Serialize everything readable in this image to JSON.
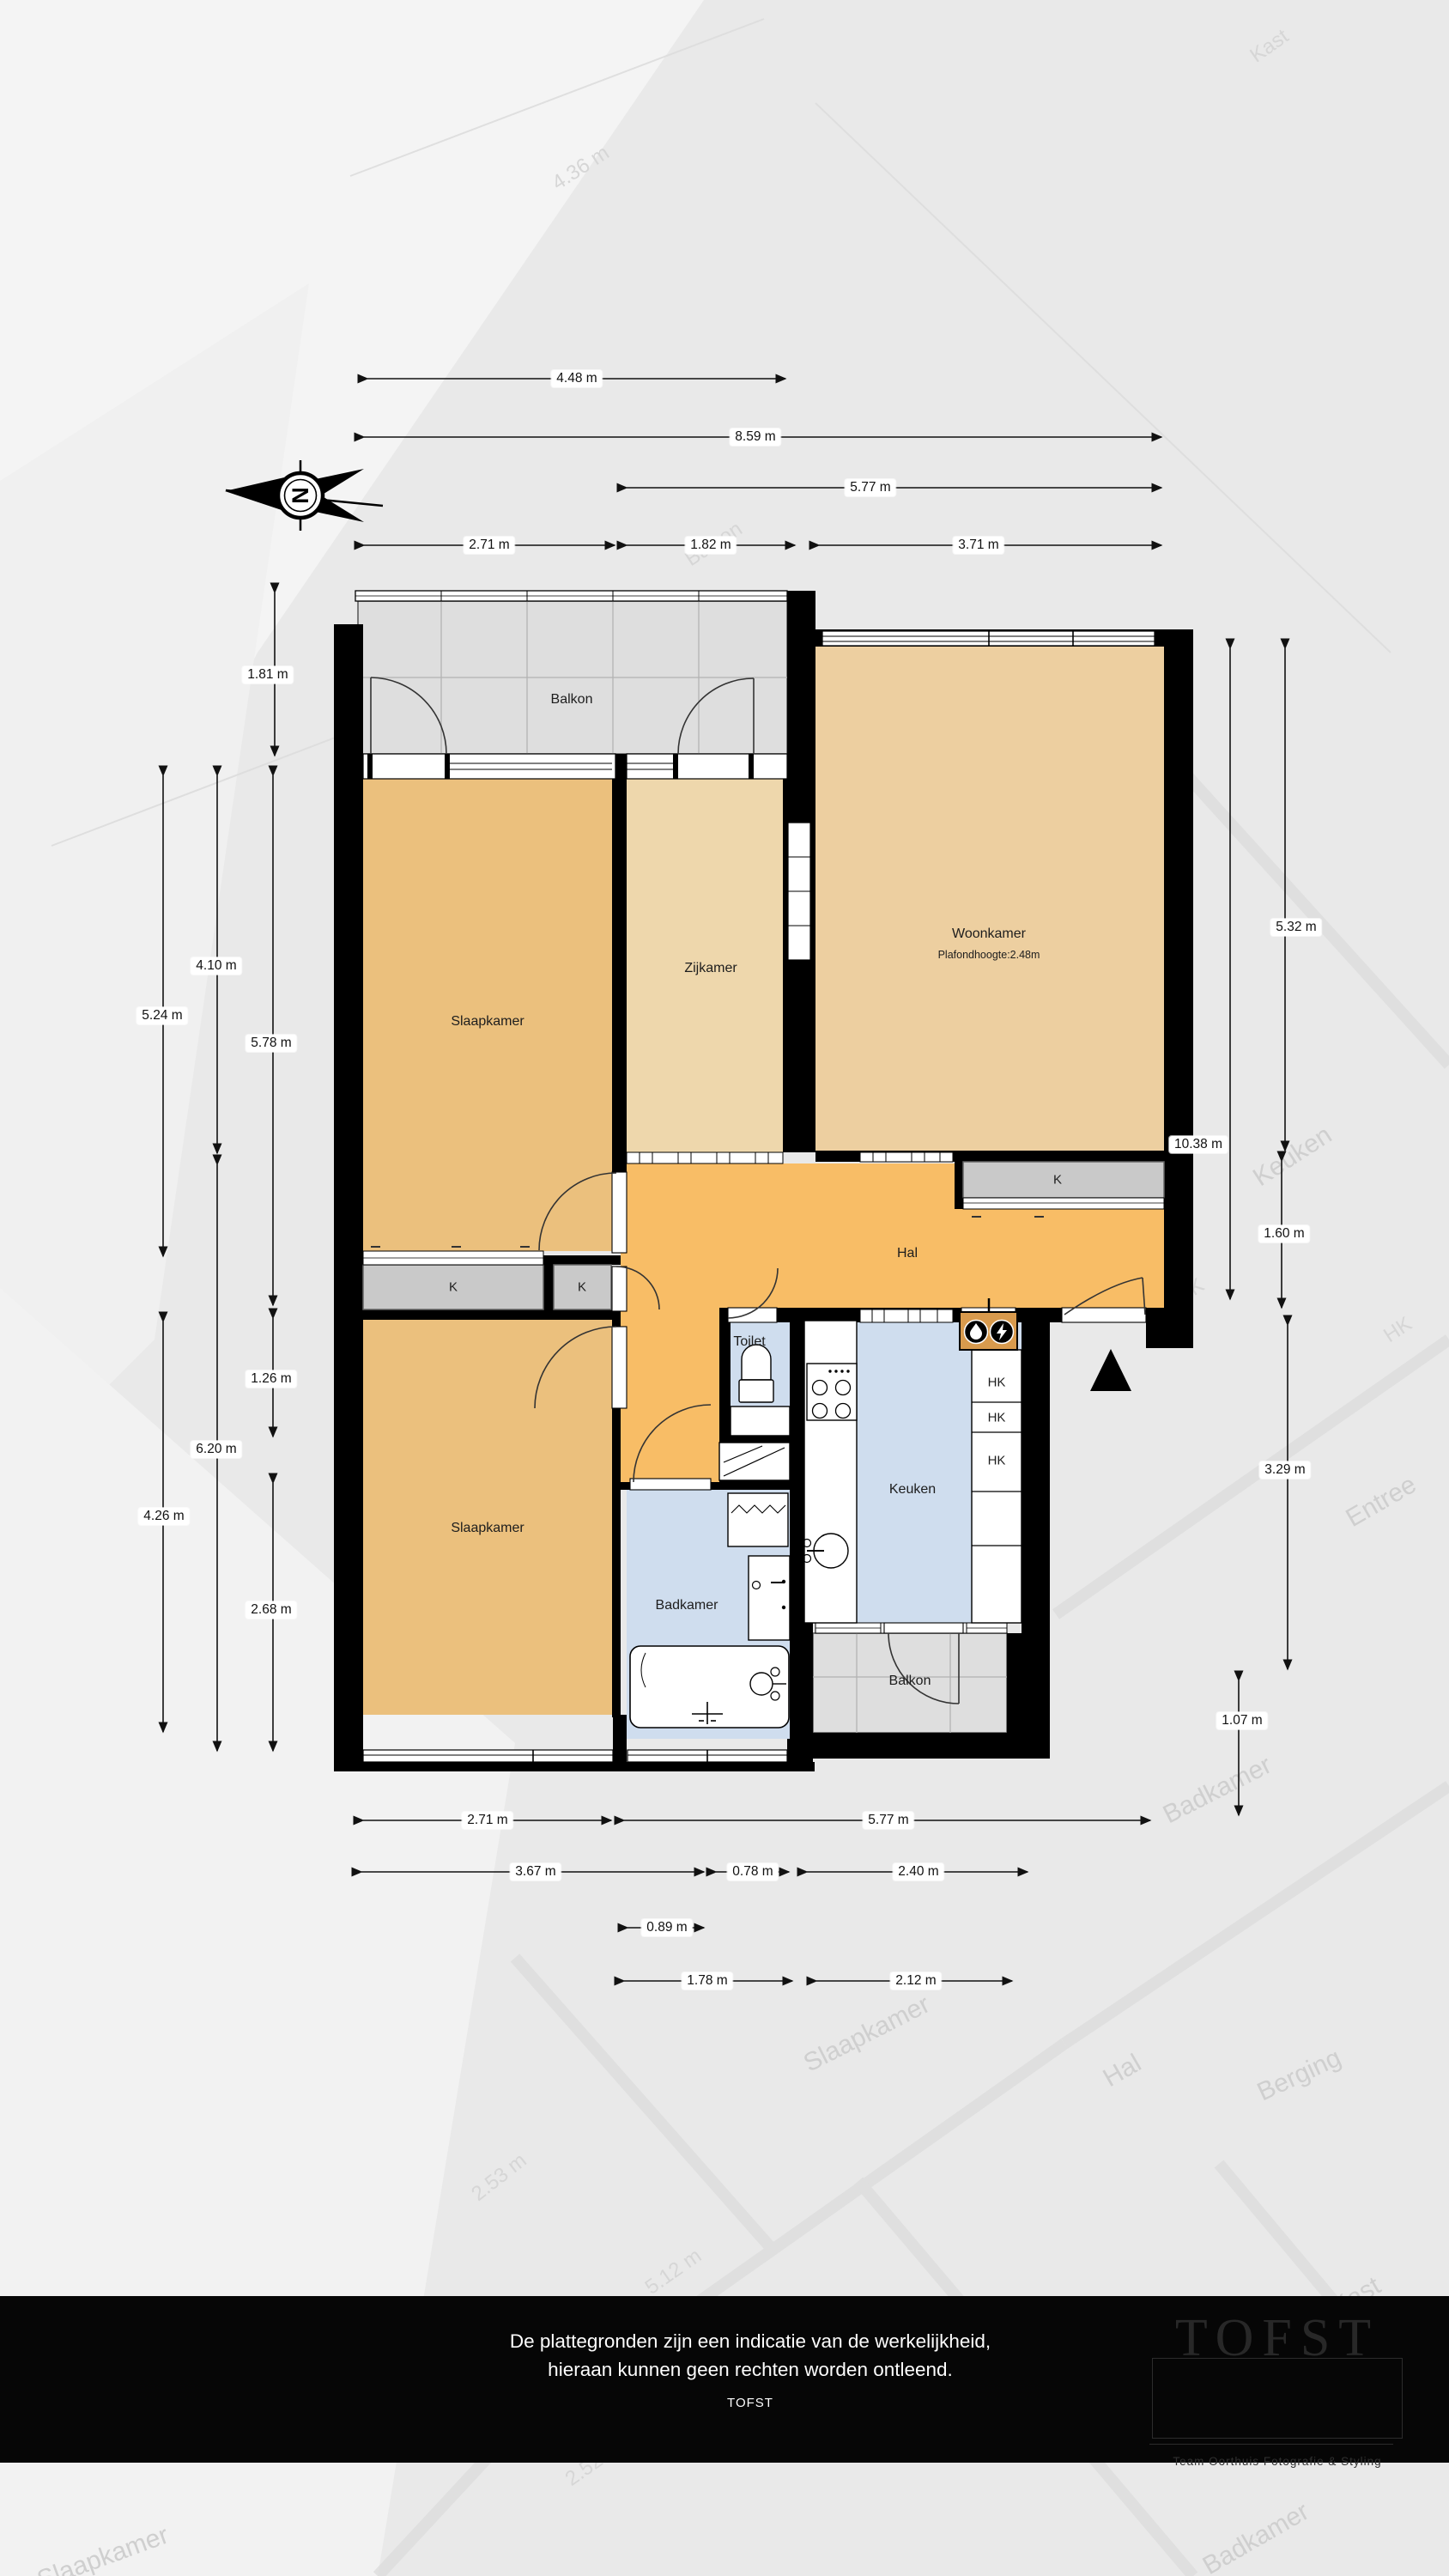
{
  "rooms": {
    "balkon_top": "Balkon",
    "slaapkamer_boven": "Slaapkamer",
    "zijkamer": "Zijkamer",
    "woonkamer": "Woonkamer",
    "woonkamer_sub": "Plafondhoogte:2.48m",
    "hal": "Hal",
    "toilet": "Toilet",
    "keuken": "Keuken",
    "slaapkamer_onder": "Slaapkamer",
    "badkamer": "Badkamer",
    "balkon_onder": "Balkon",
    "kast_links": "K",
    "kast_midden": "K",
    "kast_woonkamer": "K",
    "hk1": "HK",
    "hk2": "HK",
    "hk3": "HK"
  },
  "compass": {
    "letter": "N"
  },
  "dims": [
    {
      "label": "4.48 m"
    },
    {
      "label": "8.59 m"
    },
    {
      "label": "5.77 m"
    },
    {
      "label": "2.71 m"
    },
    {
      "label": "1.82 m"
    },
    {
      "label": "3.71 m"
    },
    {
      "label": "1.81 m"
    },
    {
      "label": "5.24 m"
    },
    {
      "label": "4.10 m"
    },
    {
      "label": "5.78 m"
    },
    {
      "label": "1.26 m"
    },
    {
      "label": "6.20 m"
    },
    {
      "label": "4.26 m"
    },
    {
      "label": "2.68 m"
    },
    {
      "label": "5.32 m"
    },
    {
      "label": "10.38 m"
    },
    {
      "label": "1.60 m"
    },
    {
      "label": "3.29 m"
    },
    {
      "label": "1.07 m"
    },
    {
      "label": "2.71 m"
    },
    {
      "label": "5.77 m"
    },
    {
      "label": "3.67 m"
    },
    {
      "label": "0.78 m"
    },
    {
      "label": "2.40 m"
    },
    {
      "label": "0.89 m"
    },
    {
      "label": "1.78 m"
    },
    {
      "label": "2.12 m"
    }
  ],
  "background_labels": [
    {
      "label": "4.36 m"
    },
    {
      "label": "Kast"
    },
    {
      "label": "Balkon"
    },
    {
      "label": "Keuken"
    },
    {
      "label": "HK"
    },
    {
      "label": "HK"
    },
    {
      "label": "Entree"
    },
    {
      "label": "Badkamer"
    },
    {
      "label": "Slaapkamer"
    },
    {
      "label": "Hal"
    },
    {
      "label": "Berging"
    },
    {
      "label": "2.53 m"
    },
    {
      "label": "5.12 m"
    },
    {
      "label": "Kast"
    },
    {
      "label": "2.52 m"
    },
    {
      "label": "Badkamer"
    },
    {
      "label": "Slaapkamer"
    }
  ],
  "footer": {
    "line1": "De plattegronden zijn een indicatie van de werkelijkheid,",
    "line2": "hieraan kunnen geen rechten worden ontleend.",
    "line3": "TOFST",
    "logo_title": "TOFST",
    "logo_subtitle": "Team Oorthuis Fotografie & Styling"
  },
  "colors": {
    "wall": "#000000",
    "slaapkamer": "#ebc07d",
    "zijkamer": "#eed7ac",
    "woonkamer": "#edcfa0",
    "hal": "#f8bd66",
    "natte_ruimte": "#cfddee",
    "kast": "#c9c9c9",
    "balkon": "#dedede",
    "meterkast": "#d89a4d"
  },
  "icons": {
    "north_arrow": "north-arrow-icon",
    "water_meter": "water-meter-icon",
    "electricity_meter": "electricity-meter-icon",
    "entrance_arrow": "entrance-arrow-icon"
  }
}
